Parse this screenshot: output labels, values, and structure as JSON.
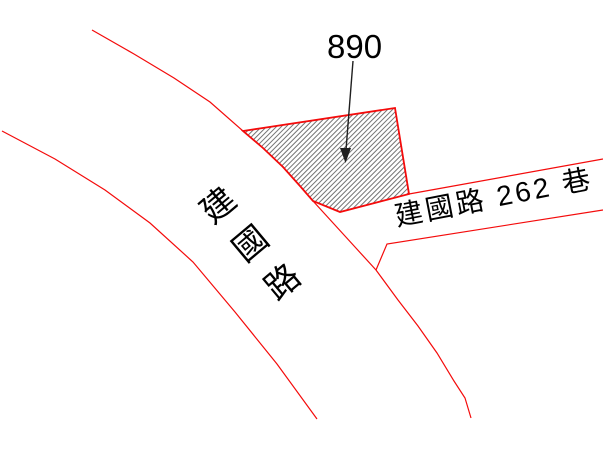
{
  "map": {
    "type": "cadastral-parcel-map",
    "labels": {
      "parcel_number": "890",
      "main_road": "建國路",
      "lane": "建國路 262 巷"
    },
    "parcel": {
      "number": "890",
      "fill_pattern": "diagonal-hatch"
    }
  },
  "colors": {
    "background": "#ffffff",
    "boundary": "#f40b0b",
    "hatch": "#737373",
    "text": "#000000",
    "arrow": "#1f1f1f"
  }
}
